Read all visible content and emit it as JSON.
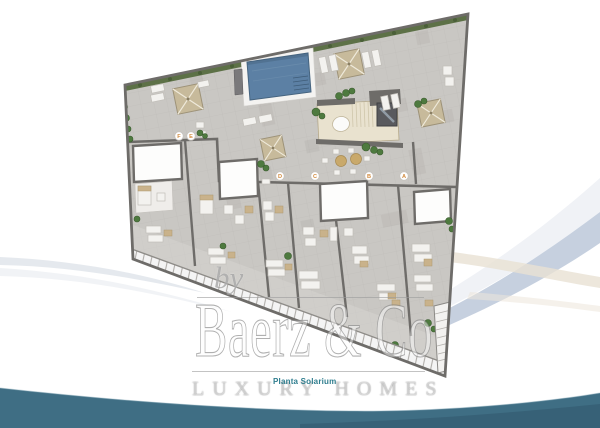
{
  "branding": {
    "by_label": "by",
    "name": "Baerz & Co",
    "tagline": "LUXURY HOMES"
  },
  "plan": {
    "caption": "Planta Solarium",
    "markers": [
      {
        "label": "F"
      },
      {
        "label": "E"
      },
      {
        "label": "D"
      },
      {
        "label": "C"
      },
      {
        "label": "B"
      },
      {
        "label": "A"
      }
    ]
  },
  "colors": {
    "floor": "#C9C7C3",
    "wall": "#6E6C69",
    "pool_water": "#5C80A4",
    "hedge": "#5D7147",
    "parasol": "#C7BA9B",
    "stair_core": "#E9E2CF",
    "marker_letter": "#D18A3D",
    "wave_teal": "#3F6E84",
    "swoosh_blue": "#C6D0DF",
    "swoosh_beige": "#E9E1D3",
    "caption_teal": "#2E7D8E"
  }
}
